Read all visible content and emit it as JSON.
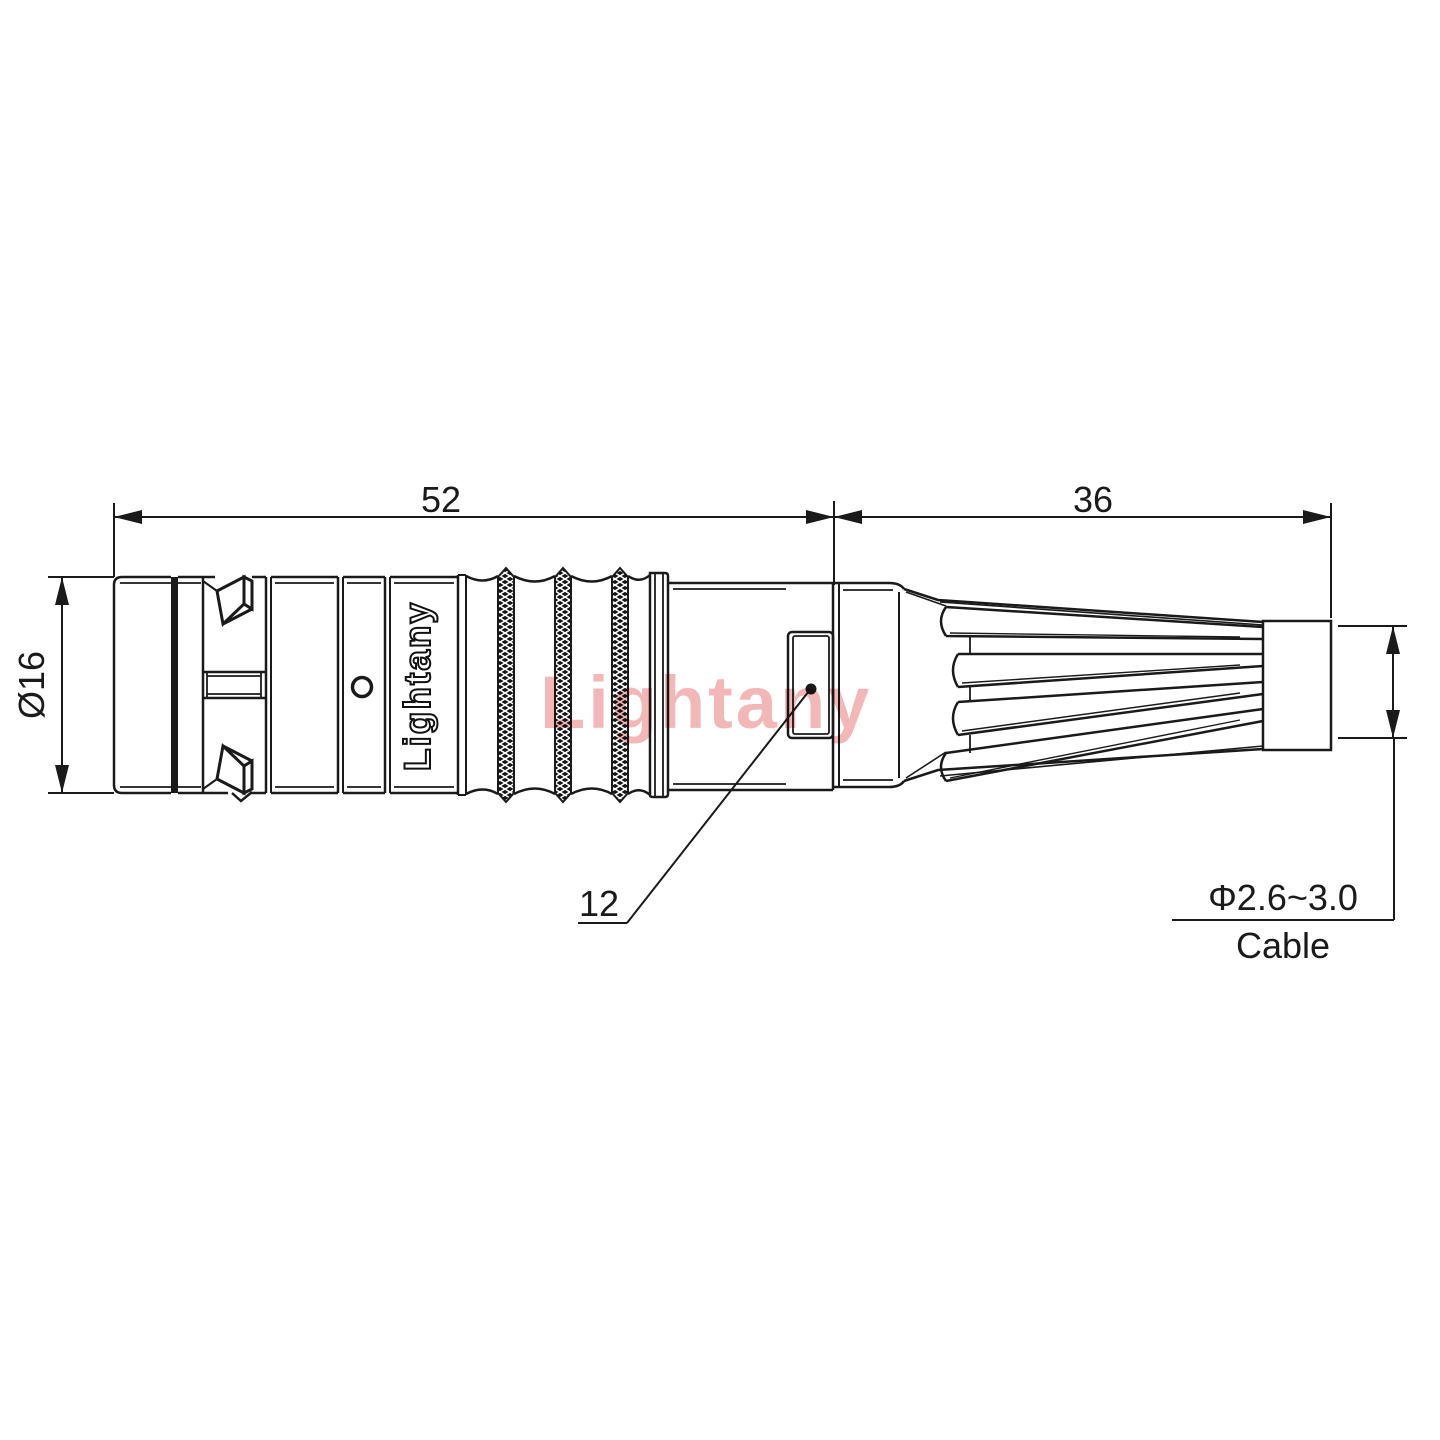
{
  "drawing": {
    "brand_text": "Lightany",
    "watermark_text": "Lightany",
    "dimensions": {
      "body_length": "52",
      "boot_length": "36",
      "outer_diameter": "Ø16",
      "coupling_size": "12",
      "cable_range": "Φ2.6~3.0",
      "cable_word": "Cable"
    },
    "colors": {
      "line": "#1a1a1a",
      "watermark": "#f2b8b8",
      "background": "#ffffff"
    }
  }
}
